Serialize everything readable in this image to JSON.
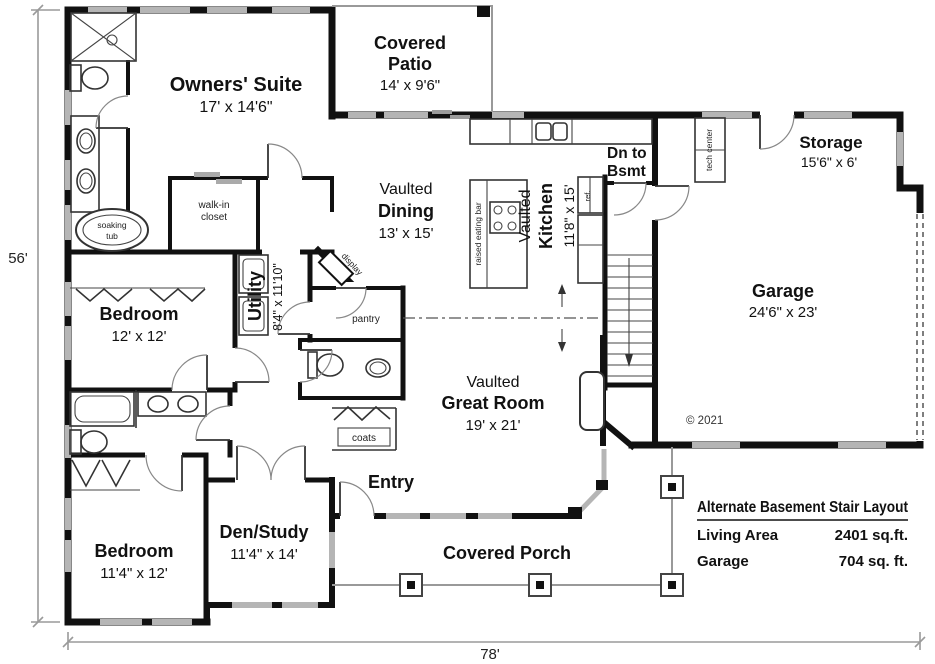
{
  "plan": {
    "rooms": {
      "owners_suite": {
        "name": "Owners' Suite",
        "dims": "17' x 14'6\""
      },
      "covered_patio": {
        "line1": "Covered",
        "line2": "Patio",
        "dims": "14' x 9'6\""
      },
      "dining": {
        "prefix": "Vaulted",
        "name": "Dining",
        "dims": "13' x 15'"
      },
      "kitchen": {
        "prefix": "Vaulted",
        "name": "Kitchen",
        "dims": "11'8\" x 15'"
      },
      "great_room": {
        "prefix": "Vaulted",
        "name": "Great Room",
        "dims": "19' x 21'"
      },
      "storage": {
        "name": "Storage",
        "dims": "15'6\" x 6'"
      },
      "garage": {
        "name": "Garage",
        "dims": "24'6\" x 23'"
      },
      "bedroom_12": {
        "name": "Bedroom",
        "dims": "12' x 12'"
      },
      "bedroom_11": {
        "name": "Bedroom",
        "dims": "11'4\" x 12'"
      },
      "den_study": {
        "name": "Den/Study",
        "dims": "11'4\" x 14'"
      },
      "utility": {
        "name": "Utility",
        "dims": "8'4\" x 11'10\""
      },
      "entry": {
        "name": "Entry"
      },
      "covered_porch": {
        "name": "Covered Porch"
      },
      "dn_to_bsmt": {
        "line1": "Dn to",
        "line2": "Bsmt"
      }
    },
    "fixtures": {
      "walk_in_line1": "walk-in",
      "walk_in_line2": "closet",
      "soaking_line1": "soaking",
      "soaking_line2": "tub",
      "display": "display",
      "pantry": "pantry",
      "coats": "coats",
      "raised_eating_bar": "raised eating bar",
      "tech_center": "tech center",
      "ref": "ref."
    },
    "dimensions": {
      "width": "78'",
      "height": "56'"
    },
    "annotations": {
      "copyright": "© 2021"
    },
    "table": {
      "title": "Alternate Basement Stair Layout",
      "rows": [
        {
          "label": "Living Area",
          "value": "2401 sq.ft."
        },
        {
          "label": "Garage",
          "value": "704 sq. ft."
        }
      ]
    },
    "colors": {
      "wall": "#111111",
      "window": "#b5b5b5",
      "porch_line": "#999999",
      "dashed_opening": "#555555"
    }
  }
}
